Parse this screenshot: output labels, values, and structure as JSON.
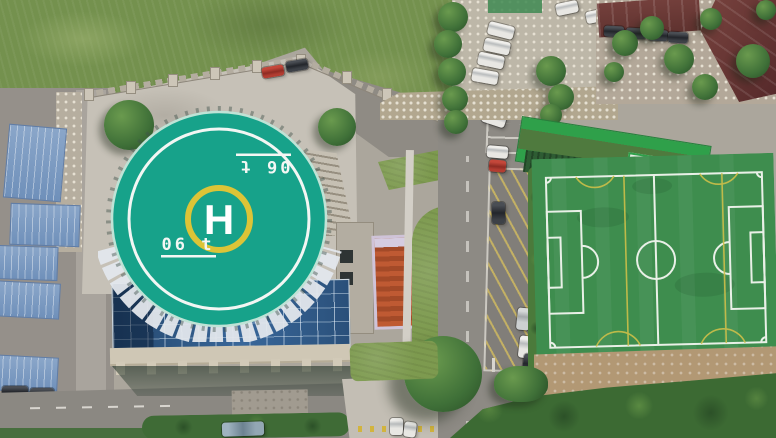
{
  "scene": {
    "title": "Aerial drone view: rooftop helipad building, campus, parking and soccer field",
    "helipad": {
      "letter": "H",
      "weight_marking": "06 t",
      "weight_marking_top": "06 t",
      "pad_color": "#17a28a",
      "outer_ring_color": "#f2f6f3",
      "h_ring_color": "#dcc437"
    },
    "soccer_field": {
      "turf_color": "#3e8d4e",
      "boundary_color": "#e9f0e7",
      "accent_line_color": "#cdbf4a"
    },
    "palette": {
      "grass": "#74914e",
      "plaza_concrete": "#c6c1b7",
      "road": "#8d8a84",
      "glass_atrium": "#2d5781",
      "blue_shed_roof": "#7e9ec6",
      "maroon_roof": "#6e3b38",
      "dirt": "#b29874",
      "vegetation": "#3c6a33"
    }
  }
}
